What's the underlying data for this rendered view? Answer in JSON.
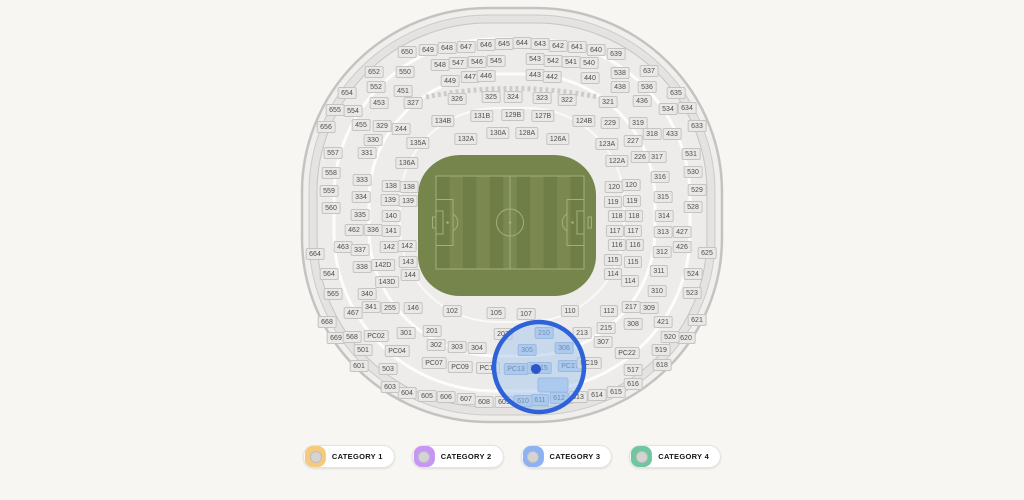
{
  "legend": {
    "items": [
      {
        "label": "CATEGORY 1",
        "color": "#f6ca7c"
      },
      {
        "label": "CATEGORY 2",
        "color": "#c795f4"
      },
      {
        "label": "CATEGORY 3",
        "color": "#8db1f2"
      },
      {
        "label": "CATEGORY 4",
        "color": "#70c69e"
      }
    ]
  },
  "stadium": {
    "colors": {
      "background": "#f7f6f3",
      "shell_fill": "#edecea",
      "ring_fill": "#e4e3e1",
      "section_bg": "#e9e8e6",
      "section_border": "#c5c4c2",
      "pitch_green": "#76854c",
      "pitch_stripe_dark": "#6f7d46",
      "pitch_stripe_light": "#7b8950",
      "pitch_line": "#aab581",
      "highlight_section": "#b5cdee",
      "selection_stroke": "#2e62d9",
      "selection_fill": "rgba(164,197,238,0.5)",
      "selection_marker": "#2d56c8"
    },
    "selection": {
      "cx": 539,
      "cy": 367,
      "r": 45,
      "stroke": "#2e62d9",
      "fill": "rgba(164,197,238,0.5)",
      "marker_cx": 536,
      "marker_cy": 369,
      "marker_color": "#2d56c8",
      "highlighted_sections": [
        "210",
        "305",
        "306",
        "PC13",
        "PC15",
        "PC17",
        "610",
        "611",
        "612"
      ]
    },
    "sections": [
      {
        "label": "650",
        "x": 407,
        "y": 52
      },
      {
        "label": "649",
        "x": 428,
        "y": 50
      },
      {
        "label": "648",
        "x": 447,
        "y": 48
      },
      {
        "label": "647",
        "x": 466,
        "y": 47
      },
      {
        "label": "646",
        "x": 486,
        "y": 45
      },
      {
        "label": "645",
        "x": 504,
        "y": 44
      },
      {
        "label": "644",
        "x": 522,
        "y": 43
      },
      {
        "label": "643",
        "x": 540,
        "y": 44
      },
      {
        "label": "642",
        "x": 558,
        "y": 46
      },
      {
        "label": "641",
        "x": 577,
        "y": 47
      },
      {
        "label": "640",
        "x": 596,
        "y": 50
      },
      {
        "label": "639",
        "x": 616,
        "y": 54
      },
      {
        "label": "652",
        "x": 374,
        "y": 72
      },
      {
        "label": "637",
        "x": 649,
        "y": 71
      },
      {
        "label": "654",
        "x": 347,
        "y": 93
      },
      {
        "label": "635",
        "x": 676,
        "y": 93
      },
      {
        "label": "655",
        "x": 335,
        "y": 110
      },
      {
        "label": "634",
        "x": 687,
        "y": 108
      },
      {
        "label": "656",
        "x": 326,
        "y": 127
      },
      {
        "label": "633",
        "x": 697,
        "y": 126
      },
      {
        "label": "664",
        "x": 315,
        "y": 254
      },
      {
        "label": "668",
        "x": 327,
        "y": 322
      },
      {
        "label": "669",
        "x": 336,
        "y": 338
      },
      {
        "label": "625",
        "x": 707,
        "y": 253
      },
      {
        "label": "621",
        "x": 697,
        "y": 320
      },
      {
        "label": "620",
        "x": 686,
        "y": 338
      },
      {
        "label": "618",
        "x": 662,
        "y": 365
      },
      {
        "label": "616",
        "x": 633,
        "y": 384
      },
      {
        "label": "615",
        "x": 616,
        "y": 392
      },
      {
        "label": "614",
        "x": 597,
        "y": 395
      },
      {
        "label": "613",
        "x": 578,
        "y": 397
      },
      {
        "label": "612",
        "x": 559,
        "y": 398,
        "h": 1
      },
      {
        "label": "611",
        "x": 540,
        "y": 400,
        "h": 1
      },
      {
        "label": "610",
        "x": 523,
        "y": 401,
        "h": 1
      },
      {
        "label": "609",
        "x": 504,
        "y": 402
      },
      {
        "label": "608",
        "x": 484,
        "y": 402
      },
      {
        "label": "607",
        "x": 466,
        "y": 399
      },
      {
        "label": "606",
        "x": 446,
        "y": 397
      },
      {
        "label": "605",
        "x": 427,
        "y": 396
      },
      {
        "label": "604",
        "x": 407,
        "y": 393
      },
      {
        "label": "603",
        "x": 390,
        "y": 387
      },
      {
        "label": "601",
        "x": 359,
        "y": 366
      },
      {
        "label": "550",
        "x": 405,
        "y": 72
      },
      {
        "label": "548",
        "x": 440,
        "y": 65
      },
      {
        "label": "547",
        "x": 458,
        "y": 63
      },
      {
        "label": "546",
        "x": 477,
        "y": 62
      },
      {
        "label": "545",
        "x": 496,
        "y": 61
      },
      {
        "label": "543",
        "x": 535,
        "y": 59
      },
      {
        "label": "542",
        "x": 553,
        "y": 61
      },
      {
        "label": "541",
        "x": 571,
        "y": 62
      },
      {
        "label": "540",
        "x": 589,
        "y": 63
      },
      {
        "label": "538",
        "x": 620,
        "y": 73
      },
      {
        "label": "552",
        "x": 376,
        "y": 87
      },
      {
        "label": "536",
        "x": 647,
        "y": 87
      },
      {
        "label": "554",
        "x": 353,
        "y": 111
      },
      {
        "label": "534",
        "x": 668,
        "y": 109
      },
      {
        "label": "557",
        "x": 333,
        "y": 153
      },
      {
        "label": "531",
        "x": 691,
        "y": 154
      },
      {
        "label": "558",
        "x": 331,
        "y": 173
      },
      {
        "label": "530",
        "x": 693,
        "y": 172
      },
      {
        "label": "559",
        "x": 329,
        "y": 191
      },
      {
        "label": "529",
        "x": 697,
        "y": 190
      },
      {
        "label": "560",
        "x": 331,
        "y": 208
      },
      {
        "label": "528",
        "x": 693,
        "y": 207
      },
      {
        "label": "564",
        "x": 329,
        "y": 274
      },
      {
        "label": "524",
        "x": 693,
        "y": 274
      },
      {
        "label": "565",
        "x": 333,
        "y": 294
      },
      {
        "label": "523",
        "x": 692,
        "y": 293
      },
      {
        "label": "568",
        "x": 352,
        "y": 337
      },
      {
        "label": "520",
        "x": 670,
        "y": 337
      },
      {
        "label": "519",
        "x": 661,
        "y": 350
      },
      {
        "label": "517",
        "x": 633,
        "y": 370
      },
      {
        "label": "501",
        "x": 363,
        "y": 350
      },
      {
        "label": "503",
        "x": 388,
        "y": 369
      },
      {
        "label": "449",
        "x": 450,
        "y": 81
      },
      {
        "label": "447",
        "x": 470,
        "y": 77
      },
      {
        "label": "446",
        "x": 486,
        "y": 76
      },
      {
        "label": "443",
        "x": 535,
        "y": 75
      },
      {
        "label": "442",
        "x": 552,
        "y": 77
      },
      {
        "label": "440",
        "x": 590,
        "y": 78
      },
      {
        "label": "451",
        "x": 403,
        "y": 91
      },
      {
        "label": "438",
        "x": 620,
        "y": 87
      },
      {
        "label": "453",
        "x": 379,
        "y": 103
      },
      {
        "label": "436",
        "x": 642,
        "y": 101
      },
      {
        "label": "455",
        "x": 361,
        "y": 125
      },
      {
        "label": "433",
        "x": 672,
        "y": 134
      },
      {
        "label": "462",
        "x": 354,
        "y": 230
      },
      {
        "label": "463",
        "x": 343,
        "y": 247
      },
      {
        "label": "467",
        "x": 353,
        "y": 313
      },
      {
        "label": "427",
        "x": 682,
        "y": 232
      },
      {
        "label": "426",
        "x": 682,
        "y": 247
      },
      {
        "label": "421",
        "x": 663,
        "y": 322
      },
      {
        "label": "327",
        "x": 413,
        "y": 103
      },
      {
        "label": "326",
        "x": 457,
        "y": 99
      },
      {
        "label": "325",
        "x": 491,
        "y": 97
      },
      {
        "label": "324",
        "x": 513,
        "y": 97
      },
      {
        "label": "323",
        "x": 542,
        "y": 98
      },
      {
        "label": "322",
        "x": 567,
        "y": 100
      },
      {
        "label": "321",
        "x": 608,
        "y": 102
      },
      {
        "label": "329",
        "x": 382,
        "y": 126
      },
      {
        "label": "319",
        "x": 638,
        "y": 123
      },
      {
        "label": "318",
        "x": 652,
        "y": 134
      },
      {
        "label": "330",
        "x": 373,
        "y": 140
      },
      {
        "label": "331",
        "x": 367,
        "y": 153
      },
      {
        "label": "317",
        "x": 657,
        "y": 157
      },
      {
        "label": "316",
        "x": 660,
        "y": 177
      },
      {
        "label": "333",
        "x": 362,
        "y": 180
      },
      {
        "label": "334",
        "x": 361,
        "y": 197
      },
      {
        "label": "315",
        "x": 663,
        "y": 197
      },
      {
        "label": "335",
        "x": 360,
        "y": 215
      },
      {
        "label": "314",
        "x": 664,
        "y": 216
      },
      {
        "label": "336",
        "x": 373,
        "y": 230
      },
      {
        "label": "313",
        "x": 663,
        "y": 232
      },
      {
        "label": "337",
        "x": 360,
        "y": 250
      },
      {
        "label": "312",
        "x": 662,
        "y": 252
      },
      {
        "label": "338",
        "x": 362,
        "y": 267
      },
      {
        "label": "311",
        "x": 659,
        "y": 271
      },
      {
        "label": "340",
        "x": 367,
        "y": 294
      },
      {
        "label": "310",
        "x": 657,
        "y": 291
      },
      {
        "label": "341",
        "x": 371,
        "y": 307
      },
      {
        "label": "309",
        "x": 649,
        "y": 308
      },
      {
        "label": "308",
        "x": 633,
        "y": 324
      },
      {
        "label": "307",
        "x": 603,
        "y": 342
      },
      {
        "label": "306",
        "x": 564,
        "y": 348,
        "h": 1
      },
      {
        "label": "305",
        "x": 527,
        "y": 350,
        "h": 1
      },
      {
        "label": "304",
        "x": 477,
        "y": 348
      },
      {
        "label": "303",
        "x": 457,
        "y": 347
      },
      {
        "label": "302",
        "x": 436,
        "y": 345
      },
      {
        "label": "301",
        "x": 406,
        "y": 333
      },
      {
        "label": "244",
        "x": 401,
        "y": 129
      },
      {
        "label": "229",
        "x": 610,
        "y": 123
      },
      {
        "label": "227",
        "x": 633,
        "y": 141
      },
      {
        "label": "226",
        "x": 640,
        "y": 157
      },
      {
        "label": "255",
        "x": 390,
        "y": 308
      },
      {
        "label": "201",
        "x": 432,
        "y": 331
      },
      {
        "label": "207",
        "x": 503,
        "y": 334
      },
      {
        "label": "210",
        "x": 544,
        "y": 333,
        "h": 1
      },
      {
        "label": "213",
        "x": 582,
        "y": 333
      },
      {
        "label": "215",
        "x": 606,
        "y": 328
      },
      {
        "label": "217",
        "x": 631,
        "y": 307
      },
      {
        "label": "134B",
        "x": 443,
        "y": 121
      },
      {
        "label": "131B",
        "x": 482,
        "y": 116
      },
      {
        "label": "129B",
        "x": 513,
        "y": 115
      },
      {
        "label": "127B",
        "x": 543,
        "y": 116
      },
      {
        "label": "124B",
        "x": 584,
        "y": 121
      },
      {
        "label": "135A",
        "x": 418,
        "y": 143
      },
      {
        "label": "132A",
        "x": 466,
        "y": 139
      },
      {
        "label": "130A",
        "x": 498,
        "y": 133
      },
      {
        "label": "128A",
        "x": 527,
        "y": 133
      },
      {
        "label": "126A",
        "x": 558,
        "y": 139
      },
      {
        "label": "123A",
        "x": 607,
        "y": 144
      },
      {
        "label": "136A",
        "x": 407,
        "y": 163
      },
      {
        "label": "122A",
        "x": 617,
        "y": 161
      },
      {
        "label": "138",
        "x": 391,
        "y": 186
      },
      {
        "label": "138",
        "x": 409,
        "y": 187
      },
      {
        "label": "139",
        "x": 390,
        "y": 200
      },
      {
        "label": "139",
        "x": 408,
        "y": 201
      },
      {
        "label": "140",
        "x": 391,
        "y": 216
      },
      {
        "label": "141",
        "x": 391,
        "y": 231
      },
      {
        "label": "142",
        "x": 389,
        "y": 247
      },
      {
        "label": "142",
        "x": 407,
        "y": 246
      },
      {
        "label": "142D",
        "x": 383,
        "y": 265
      },
      {
        "label": "143",
        "x": 408,
        "y": 262
      },
      {
        "label": "143D",
        "x": 387,
        "y": 282
      },
      {
        "label": "144",
        "x": 410,
        "y": 275
      },
      {
        "label": "146",
        "x": 413,
        "y": 308
      },
      {
        "label": "120",
        "x": 614,
        "y": 187
      },
      {
        "label": "120",
        "x": 631,
        "y": 185
      },
      {
        "label": "119",
        "x": 613,
        "y": 202
      },
      {
        "label": "119",
        "x": 632,
        "y": 201
      },
      {
        "label": "118",
        "x": 617,
        "y": 216
      },
      {
        "label": "118",
        "x": 634,
        "y": 216
      },
      {
        "label": "117",
        "x": 615,
        "y": 231
      },
      {
        "label": "117",
        "x": 633,
        "y": 231
      },
      {
        "label": "116",
        "x": 617,
        "y": 245
      },
      {
        "label": "116",
        "x": 635,
        "y": 245
      },
      {
        "label": "115",
        "x": 613,
        "y": 260
      },
      {
        "label": "115",
        "x": 633,
        "y": 262
      },
      {
        "label": "114",
        "x": 613,
        "y": 274
      },
      {
        "label": "114",
        "x": 630,
        "y": 281
      },
      {
        "label": "102",
        "x": 452,
        "y": 311
      },
      {
        "label": "105",
        "x": 496,
        "y": 313
      },
      {
        "label": "107",
        "x": 526,
        "y": 314
      },
      {
        "label": "110",
        "x": 570,
        "y": 311
      },
      {
        "label": "112",
        "x": 609,
        "y": 311
      },
      {
        "label": "PC02",
        "x": 376,
        "y": 336
      },
      {
        "label": "PC04",
        "x": 397,
        "y": 351
      },
      {
        "label": "PC07",
        "x": 434,
        "y": 363
      },
      {
        "label": "PC09",
        "x": 460,
        "y": 367
      },
      {
        "label": "PC11",
        "x": 488,
        "y": 368
      },
      {
        "label": "PC13",
        "x": 516,
        "y": 369,
        "h": 1
      },
      {
        "label": "PC15",
        "x": 539,
        "y": 368,
        "h": 1
      },
      {
        "label": "PC17",
        "x": 570,
        "y": 366,
        "h": 1
      },
      {
        "label": "PC19",
        "x": 589,
        "y": 363
      },
      {
        "label": "PC22",
        "x": 627,
        "y": 353
      }
    ]
  }
}
